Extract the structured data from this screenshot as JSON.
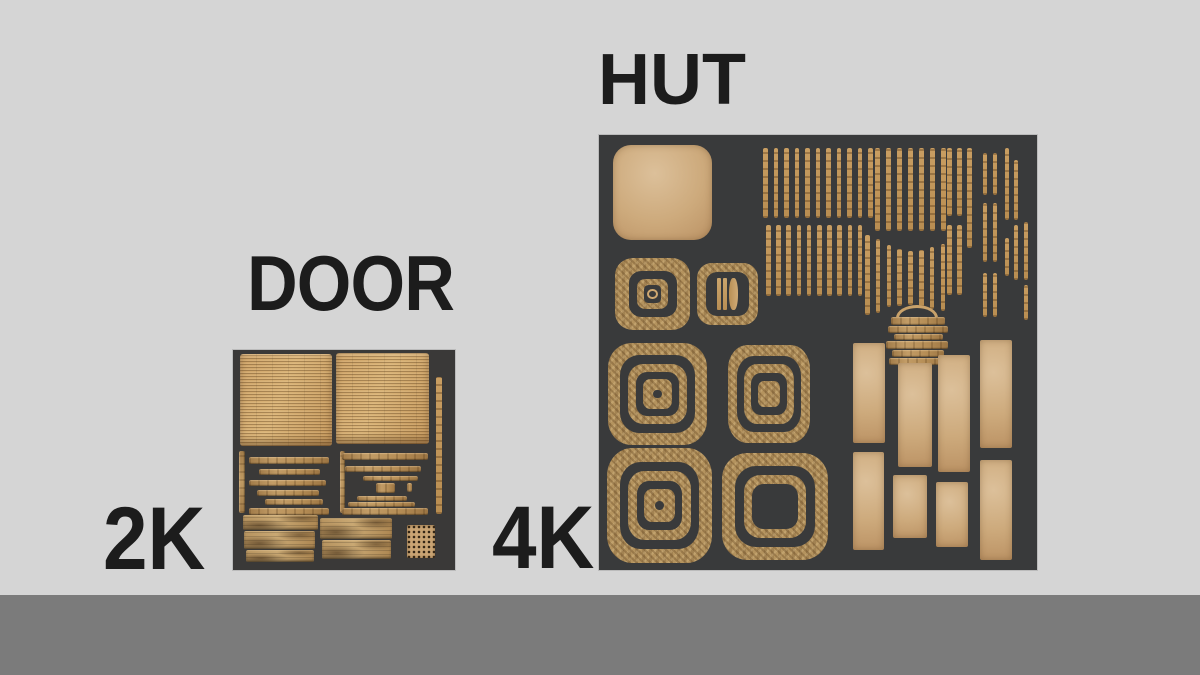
{
  "page": {
    "background": "#d5d5d5",
    "floor_color": "#7b7b7b",
    "text_color": "#1c1c1c"
  },
  "labels": {
    "hut": "HUT",
    "door": "DOOR",
    "door_resolution": "2K",
    "hut_resolution": "4K"
  },
  "atlases": {
    "door": {
      "name": "door-texture-atlas",
      "description": "2K texture atlas for DOOR asset",
      "x": 233,
      "y": 350,
      "w": 222,
      "h": 220,
      "bg": "#3a3938",
      "pieces": [
        {
          "t": "thatch",
          "x": 7,
          "y": 4,
          "w": 92,
          "h": 92
        },
        {
          "t": "thatch",
          "x": 103,
          "y": 3,
          "w": 93,
          "h": 91
        },
        {
          "t": "vstrip",
          "x": 203,
          "y": 27,
          "w": 6,
          "h": 137
        },
        {
          "t": "slatv",
          "x": 6,
          "y": 101,
          "w": 6,
          "h": 62
        },
        {
          "t": "slat",
          "x": 16,
          "y": 107,
          "w": 80,
          "h": 7
        },
        {
          "t": "slat",
          "x": 26,
          "y": 119,
          "w": 61,
          "h": 6
        },
        {
          "t": "slat",
          "x": 16,
          "y": 130,
          "w": 77,
          "h": 6
        },
        {
          "t": "slat",
          "x": 24,
          "y": 140,
          "w": 62,
          "h": 6
        },
        {
          "t": "slat",
          "x": 32,
          "y": 149,
          "w": 58,
          "h": 6
        },
        {
          "t": "slat",
          "x": 16,
          "y": 158,
          "w": 80,
          "h": 7
        },
        {
          "t": "slatv",
          "x": 107,
          "y": 101,
          "w": 5,
          "h": 62
        },
        {
          "t": "slat",
          "x": 109,
          "y": 103,
          "w": 86,
          "h": 7
        },
        {
          "t": "slat",
          "x": 112,
          "y": 116,
          "w": 76,
          "h": 6
        },
        {
          "t": "slat",
          "x": 130,
          "y": 126,
          "w": 55,
          "h": 5
        },
        {
          "t": "slat",
          "x": 143,
          "y": 133,
          "w": 19,
          "h": 10
        },
        {
          "t": "slat",
          "x": 174,
          "y": 133,
          "w": 5,
          "h": 9
        },
        {
          "t": "slat",
          "x": 124,
          "y": 146,
          "w": 50,
          "h": 5
        },
        {
          "t": "slat",
          "x": 115,
          "y": 152,
          "w": 67,
          "h": 5
        },
        {
          "t": "slat",
          "x": 109,
          "y": 158,
          "w": 86,
          "h": 7
        },
        {
          "t": "plank",
          "x": 10,
          "y": 165,
          "w": 75,
          "h": 15
        },
        {
          "t": "plank",
          "x": 11,
          "y": 181,
          "w": 71,
          "h": 18
        },
        {
          "t": "plank",
          "x": 13,
          "y": 200,
          "w": 68,
          "h": 12
        },
        {
          "t": "plank",
          "x": 87,
          "y": 168,
          "w": 72,
          "h": 21
        },
        {
          "t": "plank",
          "x": 89,
          "y": 190,
          "w": 69,
          "h": 19
        },
        {
          "t": "speckle",
          "x": 174,
          "y": 175,
          "w": 28,
          "h": 33
        }
      ]
    },
    "hut": {
      "name": "hut-texture-atlas",
      "description": "4K texture atlas for HUT asset",
      "x": 599,
      "y": 135,
      "w": 438,
      "h": 435,
      "bg": "#393a3b",
      "pieces": [
        {
          "t": "smooth",
          "x": 14,
          "y": 10,
          "w": 99,
          "h": 95,
          "r": 18
        },
        {
          "t": "target",
          "x": 16,
          "y": 123,
          "w": 75,
          "h": 72,
          "layers": [
            [
              "d",
              18
            ],
            [
              "w",
              17
            ],
            [
              "d",
              22
            ]
          ],
          "center": "circle"
        },
        {
          "t": "target",
          "x": 98,
          "y": 128,
          "w": 61,
          "h": 62,
          "layers": [
            [
              "d",
              15
            ]
          ],
          "center": "bars"
        },
        {
          "t": "strips",
          "x": 164,
          "y": 13,
          "count": 11,
          "dx": 10.5,
          "w": 4.5,
          "h": 70
        },
        {
          "t": "strips",
          "x": 276,
          "y": 13,
          "count": 7,
          "dx": 11,
          "w": 4.5,
          "h": 83
        },
        {
          "t": "strips",
          "x": 348,
          "y": 13,
          "count": 2,
          "dx": 10,
          "w": 4.5,
          "h": 68
        },
        {
          "t": "strips",
          "x": 368,
          "y": 13,
          "count": 1,
          "dx": 0,
          "w": 4.5,
          "h": 100
        },
        {
          "t": "strips",
          "x": 384,
          "y": 18,
          "count": 2,
          "dx": 10,
          "w": 4,
          "h": 42
        },
        {
          "t": "strips",
          "x": 406,
          "y": 13,
          "count": 1,
          "dx": 0,
          "w": 4,
          "h": 72
        },
        {
          "t": "strips",
          "x": 415,
          "y": 25,
          "count": 1,
          "dx": 0,
          "w": 4,
          "h": 60
        },
        {
          "t": "strips",
          "x": 167,
          "y": 90,
          "count": 10,
          "dx": 10.2,
          "w": 4.5,
          "h": 71
        },
        {
          "t": "strips",
          "x": 266,
          "count": 8,
          "dx": 10.8,
          "w": 4.5,
          "ys": [
            100,
            104,
            110,
            114,
            116,
            115,
            112,
            109
          ],
          "hs": [
            80,
            74,
            62,
            57,
            54,
            57,
            62,
            67
          ]
        },
        {
          "t": "strips",
          "x": 348,
          "y": 90,
          "count": 2,
          "dx": 10,
          "w": 4.5,
          "h": 70
        },
        {
          "t": "strips",
          "x": 384,
          "y": 68,
          "count": 2,
          "dx": 10,
          "w": 4,
          "h": 59
        },
        {
          "t": "strips",
          "x": 406,
          "y": 103,
          "count": 1,
          "dx": 0,
          "w": 4,
          "h": 38
        },
        {
          "t": "strips",
          "x": 415,
          "y": 90,
          "count": 1,
          "dx": 0,
          "w": 4,
          "h": 55
        },
        {
          "t": "strips",
          "x": 425,
          "y": 87,
          "count": 1,
          "dx": 0,
          "w": 4,
          "h": 58
        },
        {
          "t": "strips",
          "x": 384,
          "y": 138,
          "count": 2,
          "dx": 10,
          "w": 4,
          "h": 44
        },
        {
          "t": "strips",
          "x": 425,
          "y": 150,
          "count": 1,
          "dx": 0,
          "w": 4,
          "h": 35
        },
        {
          "t": "handle",
          "x": 297,
          "y": 170,
          "w": 42,
          "h": 13
        },
        {
          "t": "slat",
          "x": 292,
          "y": 182,
          "w": 54,
          "h": 8
        },
        {
          "t": "slat",
          "x": 289,
          "y": 191,
          "w": 60,
          "h": 7
        },
        {
          "t": "slat",
          "x": 295,
          "y": 199,
          "w": 49,
          "h": 6
        },
        {
          "t": "slat",
          "x": 287,
          "y": 206,
          "w": 62,
          "h": 8
        },
        {
          "t": "slat",
          "x": 293,
          "y": 215,
          "w": 52,
          "h": 7
        },
        {
          "t": "slat",
          "x": 290,
          "y": 223,
          "w": 56,
          "h": 7
        },
        {
          "t": "target",
          "x": 9,
          "y": 208,
          "w": 99,
          "h": 102,
          "layers": [
            [
              "d",
              12
            ],
            [
              "w",
              11
            ],
            [
              "d",
              14
            ],
            [
              "w",
              16
            ]
          ],
          "center": "dot"
        },
        {
          "t": "target",
          "x": 129,
          "y": 210,
          "w": 82,
          "h": 98,
          "layers": [
            [
              "d",
              11
            ],
            [
              "w",
              11
            ],
            [
              "d",
              14
            ],
            [
              "w",
              19
            ]
          ]
        },
        {
          "t": "target",
          "x": 8,
          "y": 313,
          "w": 105,
          "h": 115,
          "layers": [
            [
              "d",
              12
            ],
            [
              "w",
              11
            ],
            [
              "d",
              14
            ],
            [
              "w",
              16
            ]
          ],
          "center": "dot"
        },
        {
          "t": "target",
          "x": 123,
          "y": 318,
          "w": 106,
          "h": 107,
          "layers": [
            [
              "d",
              12
            ],
            [
              "w",
              11
            ],
            [
              "d",
              14
            ]
          ]
        },
        {
          "t": "smooth",
          "x": 254,
          "y": 208,
          "w": 32,
          "h": 100
        },
        {
          "t": "smooth",
          "x": 299,
          "y": 228,
          "w": 34,
          "h": 104
        },
        {
          "t": "smooth",
          "x": 339,
          "y": 220,
          "w": 32,
          "h": 117
        },
        {
          "t": "smooth",
          "x": 381,
          "y": 205,
          "w": 32,
          "h": 108
        },
        {
          "t": "smooth",
          "x": 254,
          "y": 317,
          "w": 31,
          "h": 98
        },
        {
          "t": "smooth",
          "x": 294,
          "y": 340,
          "w": 34,
          "h": 63
        },
        {
          "t": "smooth",
          "x": 337,
          "y": 347,
          "w": 32,
          "h": 65
        },
        {
          "t": "smooth",
          "x": 381,
          "y": 325,
          "w": 32,
          "h": 100
        }
      ]
    }
  }
}
